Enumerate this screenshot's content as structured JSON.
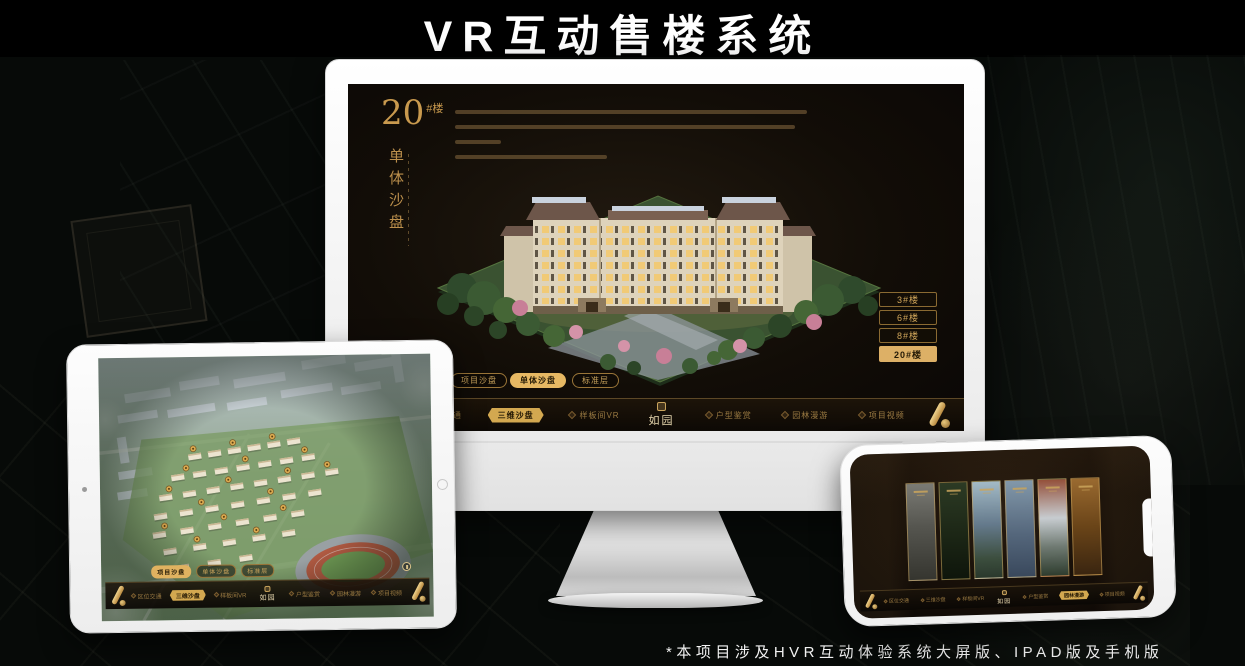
{
  "page": {
    "title": "VR互动售楼系统",
    "footnote": "*本项目涉及HVR互动体验系统大屏版、IPAD版及手机版"
  },
  "colors": {
    "gold": "#c49a52",
    "gold_bright": "#ddb066",
    "selected_fill": "#e6b863",
    "nav_text": "#9a7a42",
    "screen_bg": "#120d07"
  },
  "desktop_app": {
    "building_label": {
      "number": "20",
      "suffix": "#楼",
      "subtitle": "单体沙盘"
    },
    "floor_buttons": [
      {
        "label": "3#楼",
        "selected": false
      },
      {
        "label": "6#楼",
        "selected": false
      },
      {
        "label": "8#楼",
        "selected": false
      },
      {
        "label": "20#楼",
        "selected": true
      }
    ],
    "view_tabs": [
      {
        "label": "项目沙盘",
        "selected": false
      },
      {
        "label": "单体沙盘",
        "selected": true
      },
      {
        "label": "标准层",
        "selected": false
      }
    ],
    "nav": {
      "left_items": [
        {
          "label": "区位交通",
          "selected": false
        },
        {
          "label": "三维沙盘",
          "selected": true
        },
        {
          "label": "样板间VR",
          "selected": false
        }
      ],
      "logo": "如园",
      "right_items": [
        {
          "label": "户型鉴赏",
          "selected": false
        },
        {
          "label": "园林漫游",
          "selected": false
        },
        {
          "label": "项目视频",
          "selected": false
        }
      ]
    }
  },
  "tablet_app": {
    "view_tabs": [
      {
        "label": "项目沙盘",
        "selected": true
      },
      {
        "label": "单体沙盘",
        "selected": false
      },
      {
        "label": "标准层",
        "selected": false
      }
    ],
    "nav": {
      "left_items": [
        {
          "label": "区位交通",
          "selected": false
        },
        {
          "label": "三维沙盘",
          "selected": true
        },
        {
          "label": "样板间VR",
          "selected": false
        }
      ],
      "logo": "如园",
      "right_items": [
        {
          "label": "户型鉴赏",
          "selected": false
        },
        {
          "label": "园林漫游",
          "selected": false
        },
        {
          "label": "项目视频",
          "selected": false
        }
      ]
    }
  },
  "phone_app": {
    "nav": {
      "left_items": [
        {
          "label": "区位交通",
          "selected": false
        },
        {
          "label": "三维沙盘",
          "selected": false
        },
        {
          "label": "样板间VR",
          "selected": false
        }
      ],
      "logo": "如园",
      "right_items": [
        {
          "label": "户型鉴赏",
          "selected": false
        },
        {
          "label": "园林漫游",
          "selected": true
        },
        {
          "label": "项目视频",
          "selected": false
        }
      ]
    }
  }
}
